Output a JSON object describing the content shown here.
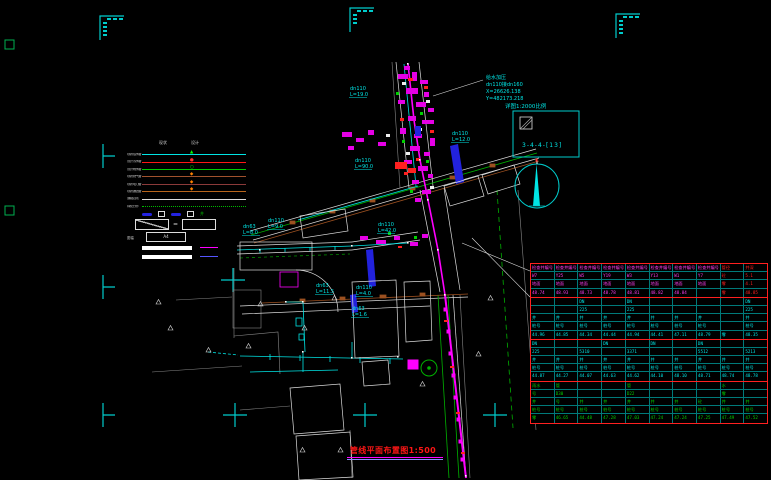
{
  "title": {
    "text": "管线平面布置图1:500"
  },
  "frame": {
    "detail_scale_label": "详图1:2000比例",
    "detail_ref": "3-4-4-[13]"
  },
  "callout": {
    "l1": "给水加压",
    "l2": "dn110接dn160",
    "l3": "X=26626.138",
    "l4": "Y=482173.218"
  },
  "pipe_labels": [
    {
      "a": "dn63",
      "b": "L=8.0"
    },
    {
      "a": "dn110",
      "b": "L=9.0"
    },
    {
      "a": "dn110",
      "b": "L=90.0"
    },
    {
      "a": "dn110",
      "b": "L=42.0"
    },
    {
      "a": "dn110",
      "b": "L=12.0"
    },
    {
      "a": "dn63",
      "b": "L=11.5"
    },
    {
      "a": "dn110",
      "b": "L=4.0"
    },
    {
      "a": "dn63",
      "b": "L=1.6"
    },
    {
      "a": "dn110",
      "b": "L=19.0"
    }
  ],
  "legend": {
    "col_headers": [
      "现状",
      "设计"
    ],
    "line_rows": [
      {
        "label": "现状给水管",
        "color": "#00e5e5",
        "marker": "▲",
        "marker_color": "#00ff00"
      },
      {
        "label": "设计污水管",
        "color": "#ff1515",
        "marker": "●",
        "marker_color": "#ff3030"
      },
      {
        "label": "设计雨水管",
        "color": "#00cc00",
        "marker": "○",
        "marker_color": "#00ff00"
      },
      {
        "label": "现状燃气管",
        "color": "#a0522d",
        "marker": "◆",
        "marker_color": "#ff8000"
      },
      {
        "label": "现状电力管",
        "color": "#8b3a3a",
        "marker": "◆",
        "marker_color": "#ff8000"
      },
      {
        "label": "现状通信管",
        "color": "#b8651b",
        "marker": "◆",
        "marker_color": "#ff8000"
      },
      {
        "label": "道路边线",
        "color": "#dddddd",
        "marker": "",
        "marker_color": ""
      },
      {
        "label": "绿化分界",
        "color": "#00bb00",
        "dotted": true,
        "marker": "",
        "marker_color": ""
      }
    ],
    "symbol_glyph": "井",
    "valve_eq": "=",
    "sheet_label": "图幅",
    "sheet_value": "A4"
  },
  "table": {
    "groups": [
      {
        "color": "#ff3df0",
        "alt_color": "#ff2020",
        "alt_cols": [
          8,
          9
        ],
        "rows": [
          [
            "检查井编号",
            "检查井编号",
            "检查井编号",
            "检查井编号",
            "检查井编号",
            "检查井编号",
            "检查井编号",
            "检查井编号",
            "管径",
            "井深"
          ],
          [
            "W7",
            "Y25",
            "W5",
            "Y19",
            "W3",
            "Y13",
            "W1",
            "Y7",
            "砼",
            "5.1"
          ],
          [
            "地面",
            "地面",
            "地面",
            "地面",
            "地面",
            "地面",
            "地面",
            "地面",
            "零",
            "4.1"
          ],
          [
            "48.74",
            "48.93",
            "48.73",
            "48.78",
            "48.81",
            "48.82",
            "48.84",
            "",
            "零",
            "48.85"
          ]
        ]
      },
      {
        "color": "#00e5e5",
        "rows": [
          [
            "",
            "",
            "DN",
            "",
            "DN",
            "",
            "",
            "",
            "",
            "DN"
          ],
          [
            "",
            "",
            "225",
            "",
            "225",
            "",
            "",
            "",
            "",
            "225"
          ],
          [
            "井",
            "井",
            "井",
            "井",
            "井",
            "井",
            "井",
            "井",
            "",
            "井"
          ],
          [
            "桩号",
            "桩号",
            "桩号",
            "桩号",
            "桩号",
            "桩号",
            "桩号",
            "桩号",
            "",
            "桩号"
          ],
          [
            "44.96",
            "44.85",
            "44.34",
            "44.44",
            "44.94",
            "44.41",
            "47.11",
            "48.79",
            "零",
            "48.35"
          ]
        ]
      },
      {
        "color": "#00e5e5",
        "rows": [
          [
            "DN",
            "",
            "",
            "DN",
            "",
            "DN",
            "",
            "DN",
            "",
            ""
          ],
          [
            "225",
            "",
            "5310",
            "",
            "3371",
            "",
            "",
            "5512",
            "",
            "5213"
          ],
          [
            "井",
            "井",
            "井",
            "井",
            "井",
            "井",
            "井",
            "井",
            "井",
            "井"
          ],
          [
            "桩号",
            "桩号",
            "桩号",
            "桩号",
            "桩号",
            "桩号",
            "桩号",
            "桩号",
            "桩号",
            "桩号"
          ],
          [
            "44.87",
            "44.27",
            "44.07",
            "44.63",
            "44.62",
            "44.10",
            "48.10",
            "48.71",
            "48.74",
            "48.78"
          ]
        ]
      },
      {
        "color": "#00d000",
        "rows": [
          [
            "雨水",
            "管",
            "",
            "",
            "管",
            "",
            "",
            "",
            "水",
            ""
          ],
          [
            "号",
            "D30",
            "",
            "",
            "D22",
            "",
            "",
            "",
            "零",
            ""
          ],
          [
            "井",
            "号",
            "井",
            "井",
            "井",
            "井",
            "井",
            "砼",
            "井",
            "井"
          ],
          [
            "桩号",
            "桩号",
            "桩号",
            "桩号",
            "桩号",
            "桩号",
            "桩号",
            "桩号",
            "桩号",
            "桩号"
          ],
          [
            "零",
            "46.65",
            "44.48",
            "47.28",
            "47.03",
            "47.24",
            "47.24",
            "47.25",
            "47.49",
            "47.52"
          ]
        ]
      }
    ]
  },
  "colors": {
    "registration": "#00cccc",
    "water": "#00e5e5",
    "sewer": "#ff00ff",
    "storm": "#00c000",
    "table_border": "#ff2020",
    "title_red": "#ff1616"
  }
}
